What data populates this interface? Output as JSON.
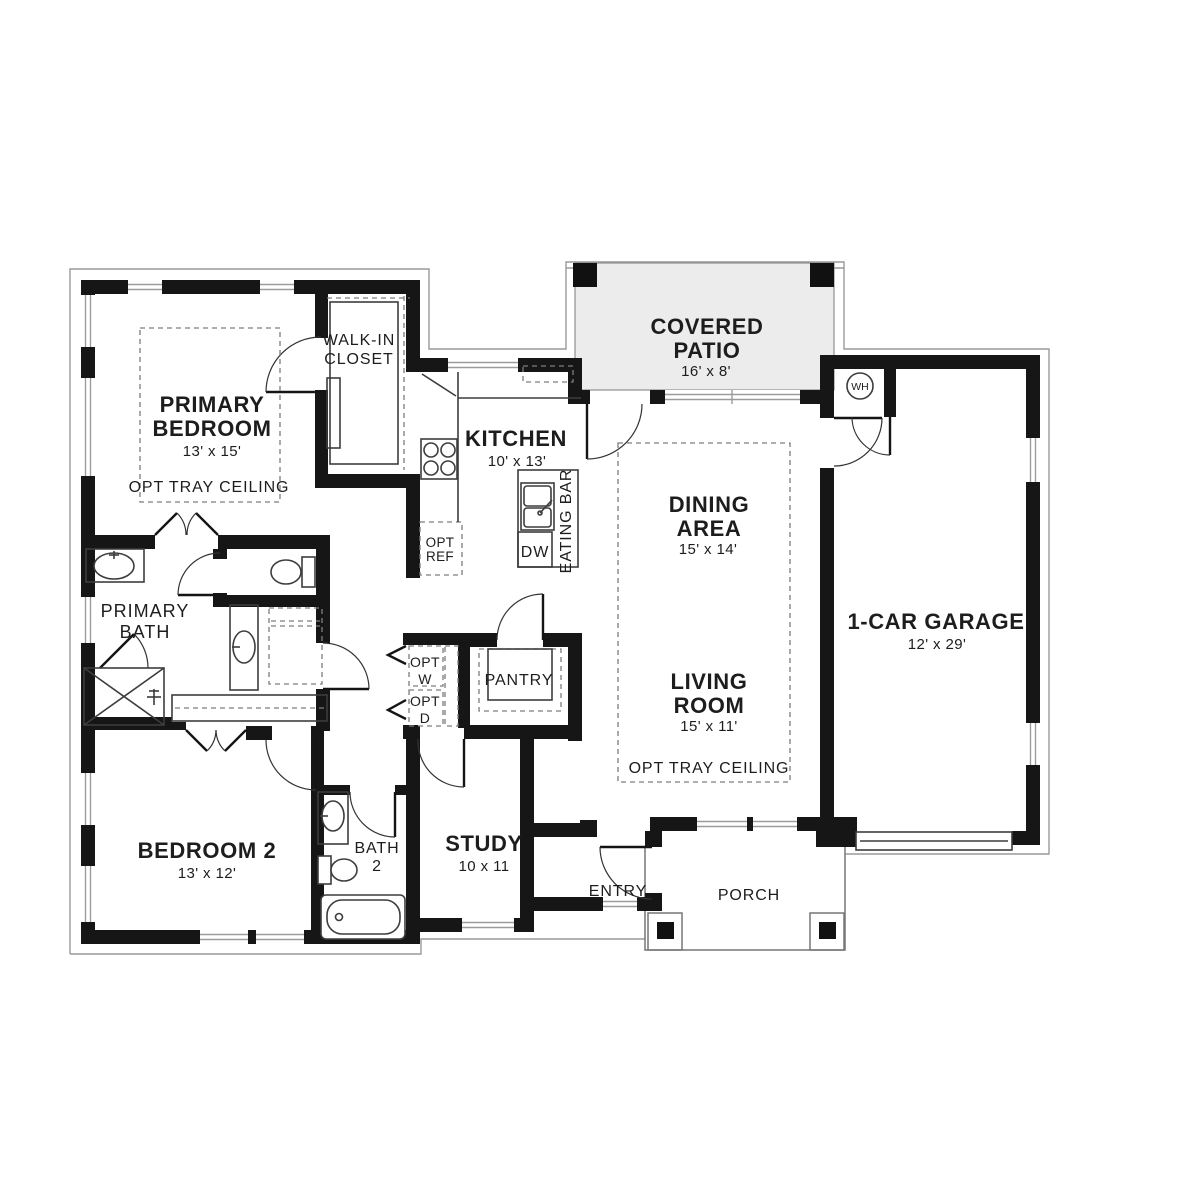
{
  "plan": {
    "colors": {
      "wall": "#161616",
      "patio_fill": "#ececec",
      "line": "#3d3d3d",
      "dash": "#7d7d7d",
      "text": "#1d1d1d"
    },
    "rooms": {
      "primary_bedroom": {
        "line1": "PRIMARY",
        "line2": "BEDROOM",
        "dims": "13' x 15'",
        "note": "OPT TRAY CEILING"
      },
      "walk_in_closet": {
        "line1": "WALK-IN",
        "line2": "CLOSET"
      },
      "kitchen": {
        "line1": "KITCHEN",
        "dims": "10' x 13'"
      },
      "eating_bar": {
        "label": "EATING BAR"
      },
      "dishwasher": {
        "label": "DW"
      },
      "opt_ref": {
        "line1": "OPT",
        "line2": "REF"
      },
      "covered_patio": {
        "line1": "COVERED",
        "line2": "PATIO",
        "dims": "16' x 8'"
      },
      "dining_area": {
        "line1": "DINING",
        "line2": "AREA",
        "dims": "15' x 14'"
      },
      "living_room": {
        "line1": "LIVING",
        "line2": "ROOM",
        "dims": "15' x 11'",
        "note": "OPT TRAY CEILING"
      },
      "garage": {
        "line1": "1-CAR GARAGE",
        "dims": "12' x 29'"
      },
      "water_heater": {
        "label": "WH"
      },
      "primary_bath": {
        "line1": "PRIMARY",
        "line2": "BATH"
      },
      "opt_washer": {
        "line1": "OPT",
        "line2": "W"
      },
      "opt_dryer": {
        "line1": "OPT",
        "line2": "D"
      },
      "pantry": {
        "label": "PANTRY"
      },
      "bedroom_2": {
        "line1": "BEDROOM 2",
        "dims": "13' x 12'"
      },
      "bath_2": {
        "line1": "BATH",
        "line2": "2"
      },
      "study": {
        "line1": "STUDY",
        "dims": "10 x 11"
      },
      "entry": {
        "label": "ENTRY"
      },
      "porch": {
        "label": "PORCH"
      }
    }
  }
}
